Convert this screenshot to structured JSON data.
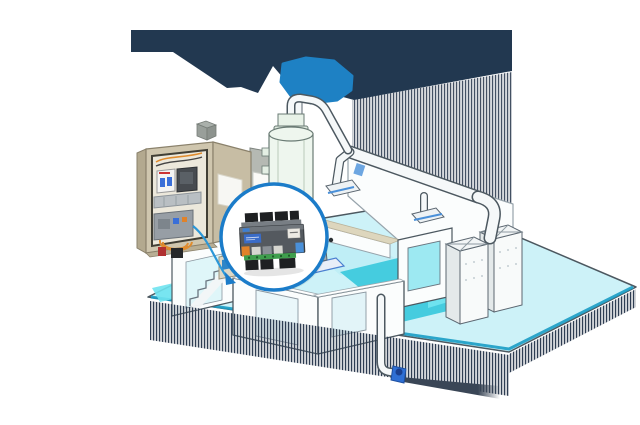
{
  "scene": {
    "description": "Isometric cutaway illustration of an industrial building with HVAC ductwork, a process tank, rooftop air-handling units, an open electrical control cabinet, and a blue-ringed magnifier callout showing a DIN-rail building automation controller connected by a blue cable. A dark navy angular banner with a bright blue folded shape spans the top; fine vertical-stripe fringe shadows hang from the banner edge and floor edges.",
    "visible_text": [],
    "parts": [
      {
        "name": "header-banner",
        "desc": "dark navy angular decorative banner with jagged lower edge"
      },
      {
        "name": "banner-accent-shape",
        "desc": "bright blue folded ribbon polygon at banner center"
      },
      {
        "name": "background-hatch",
        "desc": "fine vertical line shading between banner and building"
      },
      {
        "name": "building-floor",
        "desc": "light cyan isometric floor slab with teal front edges"
      },
      {
        "name": "shadow-fringes",
        "desc": "vertical striped drop shadows under floor edges"
      },
      {
        "name": "process-tank",
        "desc": "vertical cylindrical tank with top elbow pipe and stack"
      },
      {
        "name": "rooftop-duct",
        "desc": "white round duct running right with two floor diffuser drops"
      },
      {
        "name": "air-handling-units",
        "desc": "two white cabinets with cross-braced fan tops and dotted fronts"
      },
      {
        "name": "interior-rooms",
        "desc": "white cutaway walls with door and window openings"
      },
      {
        "name": "stairs",
        "desc": "interior staircase at left"
      },
      {
        "name": "pump-unit",
        "desc": "small grey motor on a blue base plate"
      },
      {
        "name": "drain-pipe",
        "desc": "white pipe dropping from front wall to a small blue pump"
      },
      {
        "name": "electrical-cabinet",
        "desc": "open beige cabinet with breaker, contactor, cable duct, starter, orange wiring"
      },
      {
        "name": "wall-sensor",
        "desc": "small beige wall box with blue display below cabinet"
      },
      {
        "name": "blue-signal-cable",
        "desc": "blue cable from cabinet device to magnifier callout"
      },
      {
        "name": "magnifier-callout",
        "desc": "white circle with blue ring magnifying the controller"
      },
      {
        "name": "controller-device",
        "desc": "grey DIN-rail controller: black terminal rows, blue label, white label, orange and blue connectors, green PCB strip"
      }
    ]
  },
  "colors": {
    "banner_navy": "#223850",
    "accent_blue": "#1e81c4",
    "floor_cyan": "#cdf2f8",
    "glass_cyan": "#6fe3ef",
    "teal_strip": "#45ccdf",
    "teal_edge": "#1a9cc4",
    "wall_white": "#fbfdfd",
    "outline_dark": "#4c5860",
    "outline_light": "#97a3ab",
    "fringe_dark": "#2e3d52",
    "shadow_wedge": "#3a4656",
    "cabinet_beige": "#cfc6ae",
    "cabinet_side": "#b3a98f",
    "cabinet_door": "#c7bda4",
    "ring_blue": "#1b7cc9",
    "cable_blue": "#2b97d8",
    "device_gray": "#54595f",
    "label_blue": "#3a6cc8",
    "connector_orange": "#e0822a",
    "pcb_green": "#3f9e4d",
    "terminal_black": "#1e2022",
    "pump_blue": "#2f6fd4",
    "tan_wall": "#ddd6bd",
    "tank_green": "#eef6ee",
    "pipe_white": "#f5f8f9",
    "wire_orange": "#e08c2e",
    "mcb_blue": "#3a6fd8"
  }
}
